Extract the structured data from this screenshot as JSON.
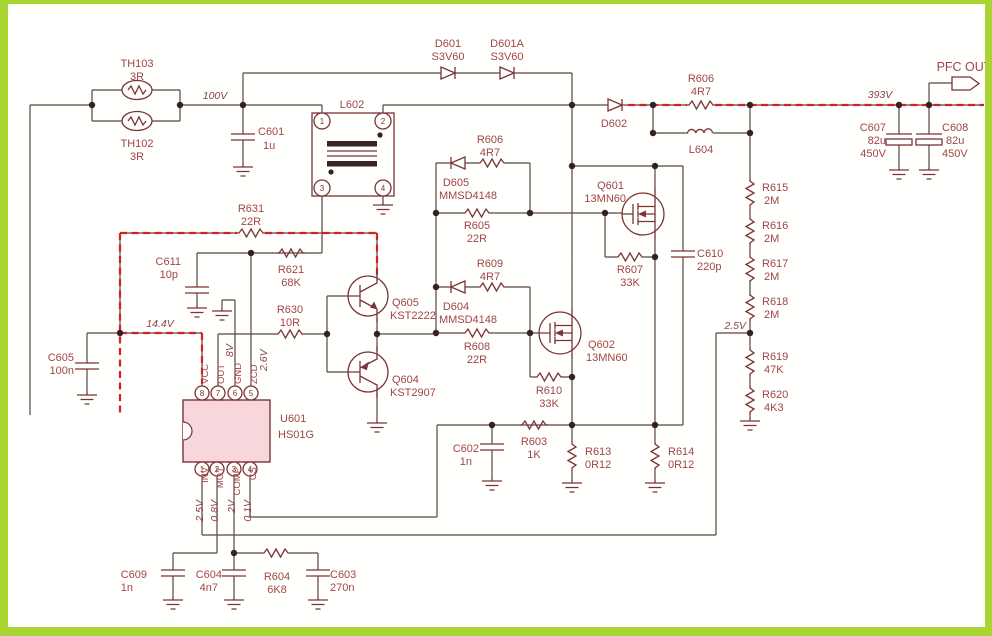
{
  "colors": {
    "border_green": "#a8d532",
    "wire": "#5a4444",
    "component": "#7a3434",
    "label_text": "#a04545",
    "trace_red": "#d42020",
    "ic_fill": "#f7d7dc"
  },
  "voltages": {
    "v100": "100V",
    "v393": "393V",
    "v14_4": "14.4V",
    "v2_5": "2.5V",
    "out": "8V",
    "zcd": "2.6V",
    "inv": "2.5V",
    "mot": "0.8V",
    "comp": "2V",
    "cs": "0.1V"
  },
  "output": {
    "label": "PFC OUT"
  },
  "ic": {
    "ref": "U601",
    "part": "HS01G",
    "pins_top": [
      {
        "n": "8",
        "name": "VCC"
      },
      {
        "n": "7",
        "name": "OUT"
      },
      {
        "n": "6",
        "name": "GND"
      },
      {
        "n": "5",
        "name": "ZCD"
      }
    ],
    "pins_bottom": [
      {
        "n": "1",
        "name": "INV"
      },
      {
        "n": "2",
        "name": "MOT"
      },
      {
        "n": "3",
        "name": "COMP"
      },
      {
        "n": "4",
        "name": "CS"
      }
    ]
  },
  "l602": {
    "ref": "L602",
    "p1": "1",
    "p2": "2",
    "p3": "3",
    "p4": "4"
  },
  "c": {
    "th103": {
      "ref": "TH103",
      "val": "3R"
    },
    "th102": {
      "ref": "TH102",
      "val": "3R"
    },
    "c601": {
      "ref": "C601",
      "val": "1u"
    },
    "d601": {
      "ref": "D601",
      "val": "S3V60"
    },
    "d601a": {
      "ref": "D601A",
      "val": "S3V60"
    },
    "d602": {
      "ref": "D602"
    },
    "r606_out": {
      "ref": "R606",
      "val": "4R7"
    },
    "l604": {
      "ref": "L604"
    },
    "c607": {
      "ref": "C607",
      "val": "82u",
      "val2": "450V"
    },
    "c608": {
      "ref": "C608",
      "val": "82u",
      "val2": "450V"
    },
    "r615": {
      "ref": "R615",
      "val": "2M"
    },
    "r616": {
      "ref": "R616",
      "val": "2M"
    },
    "r617": {
      "ref": "R617",
      "val": "2M"
    },
    "r618": {
      "ref": "R618",
      "val": "2M"
    },
    "r619": {
      "ref": "R619",
      "val": "47K"
    },
    "r620": {
      "ref": "R620",
      "val": "4K3"
    },
    "c610": {
      "ref": "C610",
      "val": "220p"
    },
    "q601": {
      "ref": "Q601",
      "val": "13MN60"
    },
    "q602": {
      "ref": "Q602",
      "val": "13MN60"
    },
    "r607": {
      "ref": "R607",
      "val": "33K"
    },
    "r610": {
      "ref": "R610",
      "val": "33K"
    },
    "d605": {
      "ref": "D605",
      "val": "MMSD4148"
    },
    "d604": {
      "ref": "D604",
      "val": "MMSD4148"
    },
    "r606_gate": {
      "ref": "R606",
      "val": "4R7"
    },
    "r609": {
      "ref": "R609",
      "val": "4R7"
    },
    "r605": {
      "ref": "R605",
      "val": "22R"
    },
    "r608": {
      "ref": "R608",
      "val": "22R"
    },
    "q605": {
      "ref": "Q605",
      "val": "KST2222"
    },
    "q604": {
      "ref": "Q604",
      "val": "KST2907"
    },
    "r630": {
      "ref": "R630",
      "val": "10R"
    },
    "r631": {
      "ref": "R631",
      "val": "22R"
    },
    "r621": {
      "ref": "R621",
      "val": "68K"
    },
    "c611": {
      "ref": "C611",
      "val": "10p"
    },
    "c605": {
      "ref": "C605",
      "val": "100n"
    },
    "c602": {
      "ref": "C602",
      "val": "1n"
    },
    "r603": {
      "ref": "R603",
      "val": "1K"
    },
    "r613": {
      "ref": "R613",
      "val": "0R12"
    },
    "r614": {
      "ref": "R614",
      "val": "0R12"
    },
    "c609": {
      "ref": "C609",
      "val": "1n"
    },
    "c604": {
      "ref": "C604",
      "val": "4n7"
    },
    "r604": {
      "ref": "R604",
      "val": "6K8"
    },
    "c603": {
      "ref": "C603",
      "val": "270n"
    }
  }
}
